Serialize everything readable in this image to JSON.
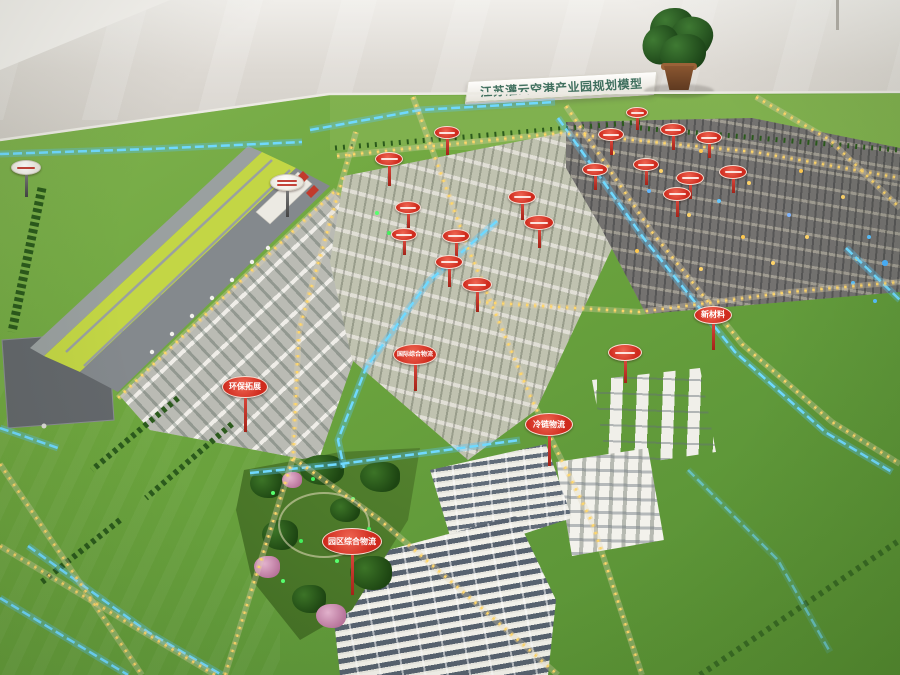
{
  "banner": {
    "text": "江苏灌云空港产业园规划模型"
  },
  "colors": {
    "grass_green": "#6fa73f",
    "sign_red": "#cf2a1d",
    "river_blue": "#6fd9ff",
    "road_light_gold": "#ffd76a",
    "banner_text": "#3f6f5e"
  },
  "signs": [
    {
      "label": "",
      "type": "r",
      "x": 447,
      "y": 126,
      "w": 26,
      "h": 13,
      "pole": 16
    },
    {
      "label": "",
      "type": "r",
      "x": 389,
      "y": 152,
      "w": 28,
      "h": 14,
      "pole": 20
    },
    {
      "label": "",
      "type": "w",
      "x": 287,
      "y": 174,
      "w": 34,
      "h": 17,
      "pole": 26,
      "lines": 2
    },
    {
      "label": "",
      "type": "r",
      "x": 408,
      "y": 201,
      "w": 26,
      "h": 13,
      "pole": 14
    },
    {
      "label": "",
      "type": "r",
      "x": 404,
      "y": 228,
      "w": 26,
      "h": 13,
      "pole": 14
    },
    {
      "label": "",
      "type": "r",
      "x": 456,
      "y": 229,
      "w": 28,
      "h": 14,
      "pole": 18
    },
    {
      "label": "",
      "type": "r",
      "x": 449,
      "y": 255,
      "w": 28,
      "h": 14,
      "pole": 18
    },
    {
      "label": "",
      "type": "r",
      "x": 522,
      "y": 190,
      "w": 28,
      "h": 14,
      "pole": 16
    },
    {
      "label": "",
      "type": "r",
      "x": 539,
      "y": 215,
      "w": 30,
      "h": 15,
      "pole": 18
    },
    {
      "label": "",
      "type": "r",
      "x": 477,
      "y": 277,
      "w": 30,
      "h": 15,
      "pole": 20
    },
    {
      "label": "",
      "type": "r",
      "x": 637,
      "y": 107,
      "w": 22,
      "h": 11,
      "pole": 12
    },
    {
      "label": "",
      "type": "r",
      "x": 611,
      "y": 128,
      "w": 26,
      "h": 13,
      "pole": 14
    },
    {
      "label": "",
      "type": "r",
      "x": 673,
      "y": 123,
      "w": 26,
      "h": 13,
      "pole": 14
    },
    {
      "label": "",
      "type": "r",
      "x": 709,
      "y": 131,
      "w": 26,
      "h": 13,
      "pole": 14
    },
    {
      "label": "",
      "type": "r",
      "x": 595,
      "y": 163,
      "w": 26,
      "h": 13,
      "pole": 14
    },
    {
      "label": "",
      "type": "r",
      "x": 646,
      "y": 158,
      "w": 26,
      "h": 13,
      "pole": 14
    },
    {
      "label": "",
      "type": "r",
      "x": 690,
      "y": 171,
      "w": 28,
      "h": 14,
      "pole": 14
    },
    {
      "label": "",
      "type": "r",
      "x": 733,
      "y": 165,
      "w": 28,
      "h": 14,
      "pole": 14
    },
    {
      "label": "",
      "type": "r",
      "x": 677,
      "y": 187,
      "w": 28,
      "h": 14,
      "pole": 16
    },
    {
      "label": "",
      "type": "r",
      "x": 625,
      "y": 344,
      "w": 34,
      "h": 17,
      "pole": 22
    },
    {
      "label": "新材料",
      "type": "r",
      "x": 713,
      "y": 306,
      "w": 38,
      "h": 18,
      "pole": 26,
      "font": 8
    },
    {
      "label": "环保拓展",
      "type": "r",
      "x": 245,
      "y": 376,
      "w": 46,
      "h": 22,
      "pole": 34,
      "font": 8
    },
    {
      "label": "冷链物流",
      "type": "r",
      "x": 549,
      "y": 413,
      "w": 48,
      "h": 23,
      "pole": 30,
      "font": 8
    },
    {
      "label": "园区综合物流",
      "type": "r",
      "x": 352,
      "y": 528,
      "w": 60,
      "h": 27,
      "pole": 40,
      "font": 8
    },
    {
      "label": "国际综合物流",
      "type": "r",
      "x": 415,
      "y": 344,
      "w": 44,
      "h": 21,
      "pole": 26,
      "font": 6
    },
    {
      "label": "",
      "type": "w",
      "x": 26,
      "y": 160,
      "w": 30,
      "h": 15,
      "pole": 22
    }
  ]
}
